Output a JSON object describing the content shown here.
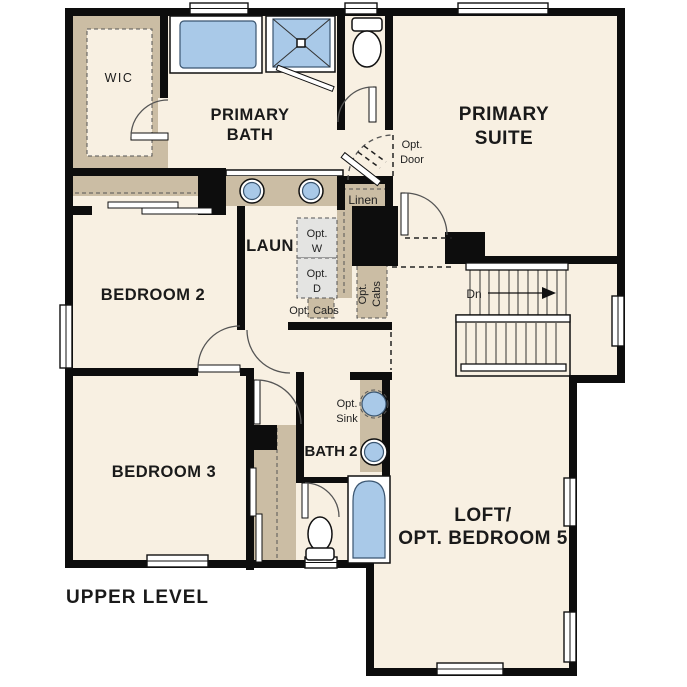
{
  "plan": {
    "title": "UPPER LEVEL",
    "rooms": {
      "wic": "WIC",
      "primary_bath_1": "PRIMARY",
      "primary_bath_2": "BATH",
      "primary_suite_1": "PRIMARY",
      "primary_suite_2": "SUITE",
      "bedroom2": "BEDROOM 2",
      "bedroom3": "BEDROOM 3",
      "laundry": "LAUN",
      "bath2": "BATH 2",
      "loft_1": "LOFT/",
      "loft_2": "OPT. BEDROOM 5"
    },
    "annotations": {
      "opt_door_1": "Opt.",
      "opt_door_2": "Door",
      "linen": "Linen",
      "opt_w_1": "Opt.",
      "opt_w_2": "W",
      "opt_d_1": "Opt.",
      "opt_d_2": "D",
      "opt_cabs": "Opt. Cabs",
      "opt_cabs_v_1": "Opt.",
      "opt_cabs_v_2": "Cabs",
      "opt_sink_1": "Opt.",
      "opt_sink_2": "Sink",
      "stairs_down": "Dn"
    },
    "colors": {
      "floor": "#f8f0e2",
      "cabinet_tan": "#cbbda4",
      "fixture_blue": "#a9c9e8",
      "appliance_gray": "#e4e4e2",
      "wall": "#0d0d0d"
    }
  }
}
